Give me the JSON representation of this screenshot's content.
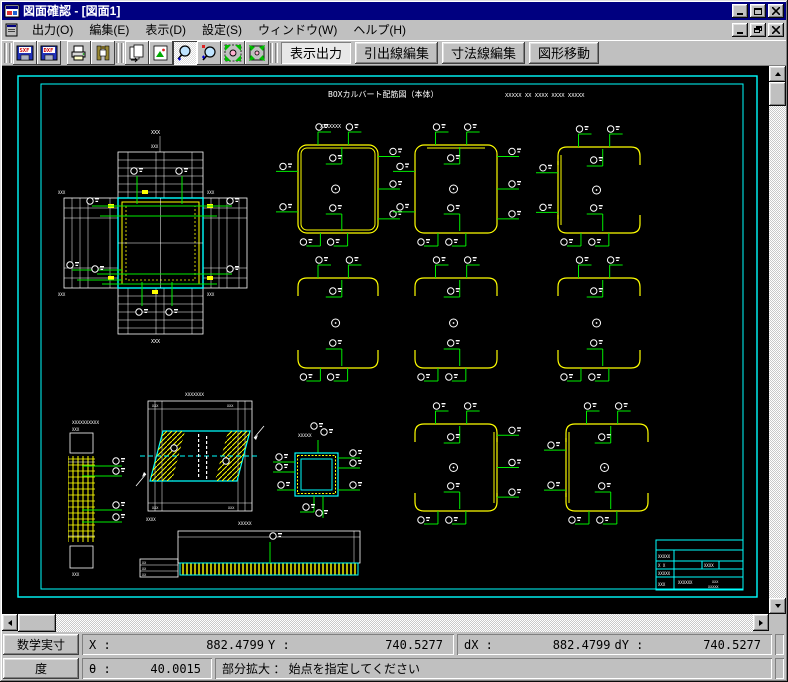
{
  "window": {
    "title": "図面確認 - [図面1]"
  },
  "titlebar": {
    "buttons": [
      {
        "name": "minimize-button"
      },
      {
        "name": "maximize-button"
      },
      {
        "name": "close-button"
      }
    ]
  },
  "menus": [
    {
      "label": "出力(O)"
    },
    {
      "label": "編集(E)"
    },
    {
      "label": "表示(D)"
    },
    {
      "label": "設定(S)"
    },
    {
      "label": "ウィンドウ(W)"
    },
    {
      "label": "ヘルプ(H)"
    }
  ],
  "toolbar": {
    "icon_buttons": [
      {
        "name": "save-sxf",
        "label": "SXF",
        "pressed": false
      },
      {
        "name": "save-dxf",
        "label": "DXF",
        "pressed": false
      },
      {
        "name": "print",
        "pressed": false
      },
      {
        "name": "plotter-output",
        "pressed": false
      },
      {
        "name": "copy-drawing",
        "pressed": false
      },
      {
        "name": "image-output",
        "pressed": false
      },
      {
        "name": "zoom-in",
        "pressed": true
      },
      {
        "name": "zoom-dynamic",
        "pressed": false
      },
      {
        "name": "zoom-partial",
        "pressed": false
      },
      {
        "name": "zoom-fit",
        "pressed": false
      }
    ],
    "text_buttons": [
      {
        "label": "表示出力",
        "active": true
      },
      {
        "label": "引出線編集",
        "active": false
      },
      {
        "label": "寸法線編集",
        "active": false
      },
      {
        "label": "図形移動",
        "active": false
      }
    ]
  },
  "status": {
    "row1": {
      "unit_button": "数学実寸",
      "x_label": "X :",
      "x_value": "882.4799",
      "y_label": "Y :",
      "y_value": "740.5277",
      "dx_label": "dX :",
      "dx_value": "882.4799",
      "dy_label": "dY :",
      "dy_value": "740.5277"
    },
    "row2": {
      "angle_button": "度",
      "theta_label": "θ :",
      "theta_value": "40.0015",
      "message": "部分拡大 ： 始点を指定してください"
    }
  },
  "canvas": {
    "background": "#000000",
    "colors": {
      "frame": "#00ffff",
      "detail": "#ffff00",
      "leader": "#00ee00",
      "line": "#ffffff"
    },
    "paper_title": {
      "text": "BOXカルバート配筋図（本体）",
      "x": 326,
      "y": 31
    },
    "paper_title_marks": {
      "text": "XXXXX   XX   XXXX   XXXX   XXXXX",
      "x": 503,
      "y": 31
    },
    "outer_frame": {
      "x": 16,
      "y": 10,
      "w": 739,
      "h": 521
    },
    "inner_frame": {
      "x": 39,
      "y": 18,
      "w": 702,
      "h": 505
    },
    "section": {
      "x": 116,
      "y": 132,
      "w": 85,
      "h": 90
    },
    "boxes": [
      {
        "x": 296,
        "y": 79,
        "w": 80,
        "h": 88,
        "style": "full"
      },
      {
        "x": 413,
        "y": 79,
        "w": 82,
        "h": 88,
        "style": "single"
      },
      {
        "x": 556,
        "y": 81,
        "w": 82,
        "h": 86,
        "style": "leftdbl"
      },
      {
        "x": 296,
        "y": 212,
        "w": 80,
        "h": 90,
        "style": "open"
      },
      {
        "x": 413,
        "y": 212,
        "w": 82,
        "h": 90,
        "style": "open"
      },
      {
        "x": 556,
        "y": 212,
        "w": 82,
        "h": 90,
        "style": "open"
      },
      {
        "x": 413,
        "y": 358,
        "w": 82,
        "h": 87,
        "style": "rightdbl"
      },
      {
        "x": 564,
        "y": 358,
        "w": 82,
        "h": 87,
        "style": "leftdbl"
      }
    ],
    "strip": {
      "label": "XXXXXXXXXX",
      "x": 66,
      "y": 355
    },
    "skew": {
      "label": "XXXXXXX",
      "x": 146,
      "y": 335
    },
    "small_box": {
      "label": "XXXXX",
      "x": 293,
      "y": 387
    },
    "bar": {
      "label": "XXXXX",
      "x": 176,
      "y": 465
    },
    "title_block": {
      "x": 654,
      "y": 474,
      "w": 87,
      "h": 50,
      "texts": [
        "XXXXX",
        "X  X",
        "XXXX",
        "XXXXX",
        "XXX",
        "XXXXXX",
        "XXX",
        "XXXXX"
      ]
    }
  }
}
